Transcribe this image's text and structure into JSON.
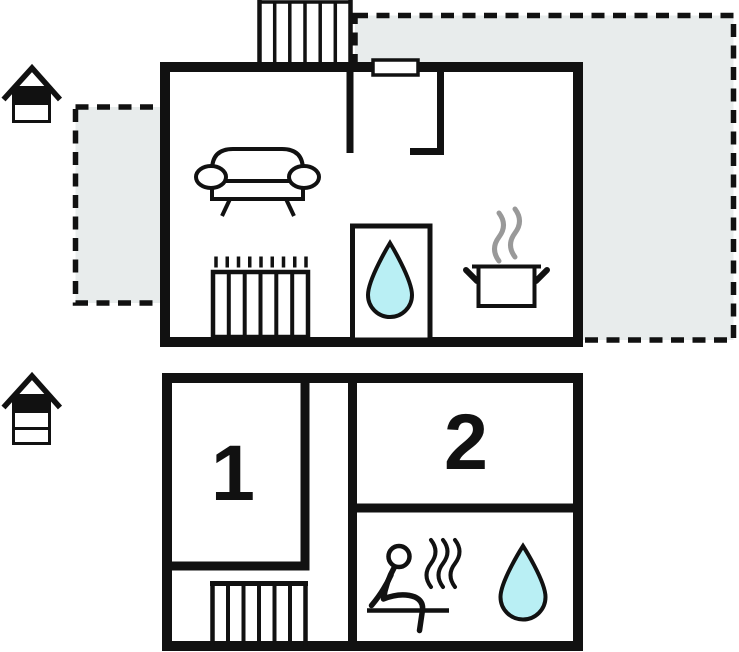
{
  "title": "Holiday home floor plan",
  "colors": {
    "wall": "#111111",
    "terrace_fill": "#e8ecec",
    "water_fill": "#b9eff4",
    "steam": "#999999"
  },
  "floors": {
    "upper": {
      "indicator_icon": "house-upper-level-icon",
      "features": [
        "terrace-left",
        "terrace-right",
        "staircase",
        "window",
        "sofa",
        "radiator",
        "shower-room",
        "water-drop",
        "cooking-pot",
        "pot-steam"
      ]
    },
    "lower": {
      "indicator_icon": "house-lower-level-icon",
      "rooms": [
        {
          "label": "1"
        },
        {
          "label": "2"
        }
      ],
      "features": [
        "staircase",
        "sauna-person",
        "sauna-steam",
        "water-drop",
        "bench"
      ]
    }
  }
}
